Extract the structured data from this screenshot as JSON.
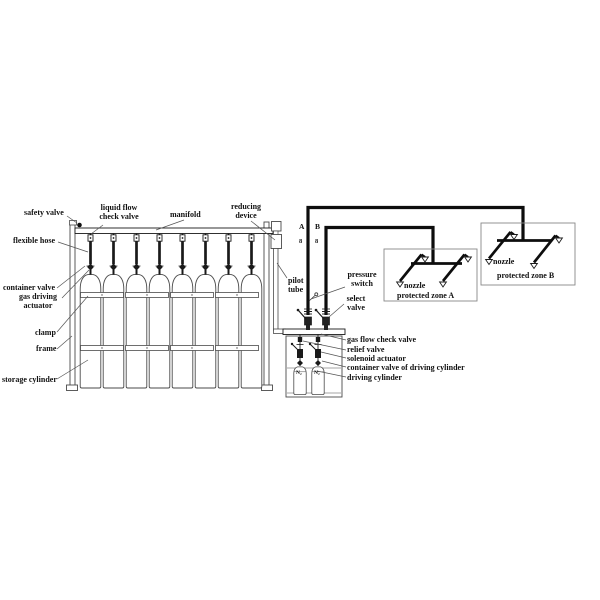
{
  "labels": {
    "safety_valve": "safety valve",
    "liquid_flow_check_valve": "liquid flow\ncheck valve",
    "manifold": "manifold",
    "reducing_device": "reducing\ndevice",
    "flexible_hose": "flexible hose",
    "container_valve": "container valve",
    "gas_driving_actuator": "gas driving\nactuator",
    "clamp": "clamp",
    "frame": "frame",
    "storage_cylinder": "storage cylinder",
    "pilot_tube": "pilot\ntube",
    "pressure_switch": "pressure\nswitch",
    "select_valve": "select\nvalve",
    "gas_flow_check_valve": "gas flow check valve",
    "relief_valve": "relief valve",
    "solenoid_actuator": "solenoid actuator",
    "container_valve_of_driving_cylinder": "container valve of driving cylinder",
    "driving_cylinder": "driving cylinder",
    "nozzle_a": "nozzle",
    "nozzle_b": "nozzle",
    "protected_zone_a": "protected zone A",
    "protected_zone_b": "protected zone B",
    "line_a": "A",
    "line_b": "B",
    "line_a_mark": "8",
    "line_b_mark": "8",
    "n2_left": "N₂",
    "n2_right": "N₂"
  },
  "colors": {
    "line": "#1a1a1a",
    "thin_line": "#555555",
    "zone_border": "#888888",
    "background": "#ffffff"
  },
  "counts": {
    "storage_cylinders": 8,
    "driving_cylinders": 2,
    "nozzles_per_zone": 4,
    "protected_zones": 2
  }
}
